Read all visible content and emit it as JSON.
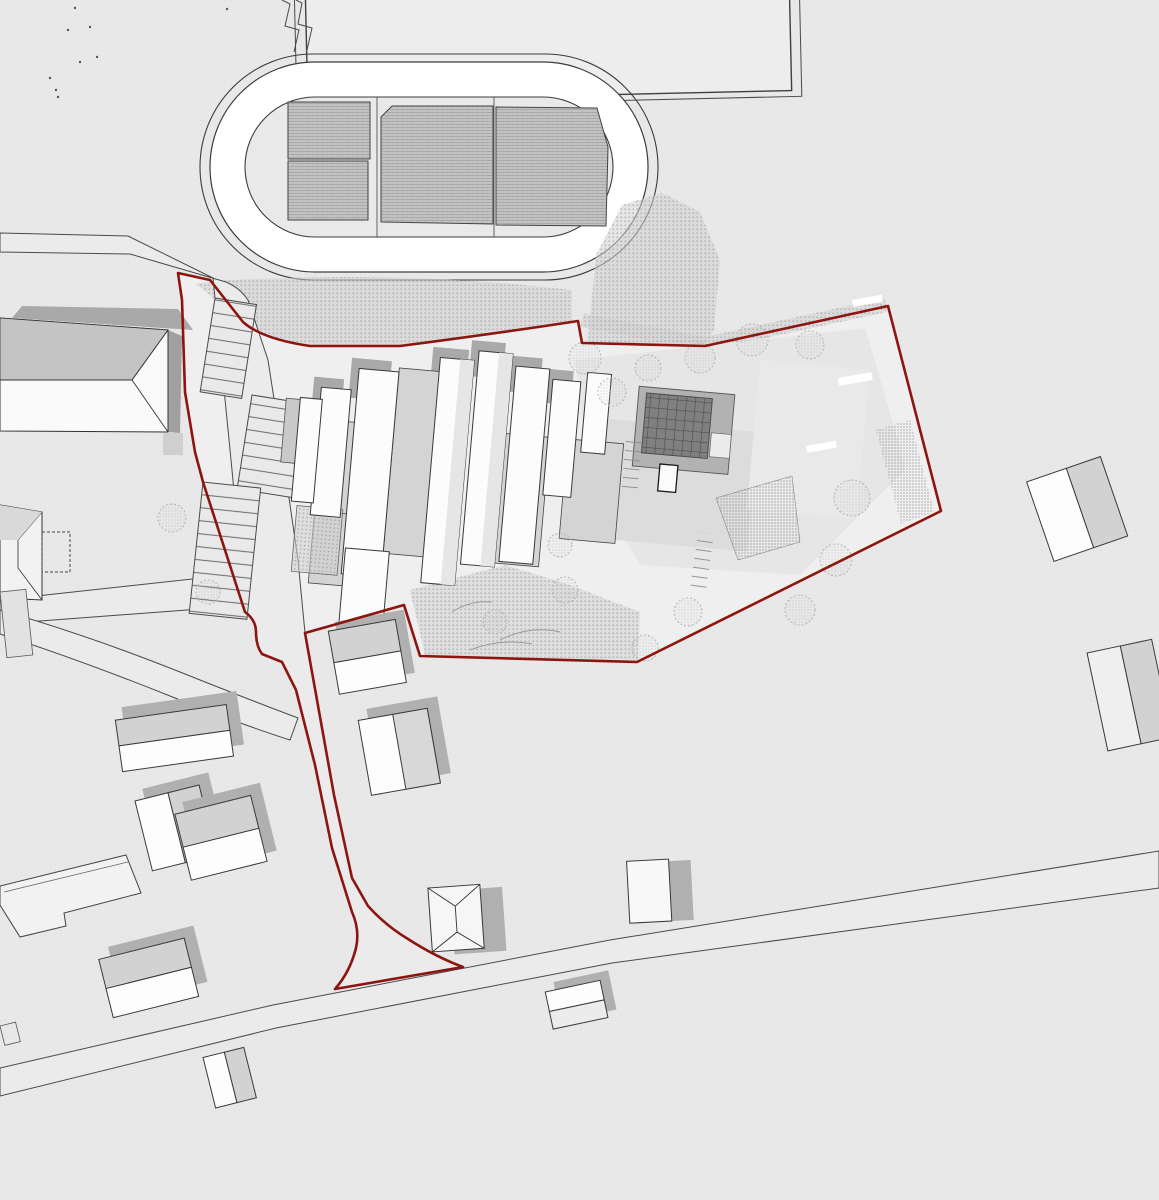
{
  "document": {
    "kind": "architectural site plan",
    "has_text_labels": false
  },
  "colors": {
    "bg": "#e8e8e8",
    "campus": "#efefef",
    "road": "#ebebeb",
    "road_line": "#4a4a4a",
    "outline": "#3a3a3a",
    "track_white": "#ffffff",
    "infield": "#e9e9e9",
    "field": "#ededed",
    "white_roof": "#fafafa",
    "gray_roof": "#c4c4c4",
    "mid_gray": "#d6d6d6",
    "connector": "#d4d4d4",
    "slab": "#e4e4e4",
    "shadow": "#a8a8a8",
    "stipple": "#a5a5a5",
    "court": "#bdbdbd",
    "court_line": "#9a9a9a",
    "panel": "#7f7f7f",
    "panel_line": "#4d4d4d",
    "boundary": "#8c1510",
    "tree": "#b5b5b5",
    "speck": "#555555"
  },
  "features": {
    "site_boundary": "site-boundary",
    "running_track": "running-track",
    "sports_field": "sports-field",
    "sports_courts": "sports-courts",
    "school_campus": "school-campus-buildings",
    "solar_roof": "solar-panel-roof",
    "embankment": "planted-embankment",
    "parking": "parking-bays",
    "street": "access-street",
    "bottom_road": "main-road",
    "houses": "residential-houses",
    "west_building": "gable-roof-hall"
  }
}
